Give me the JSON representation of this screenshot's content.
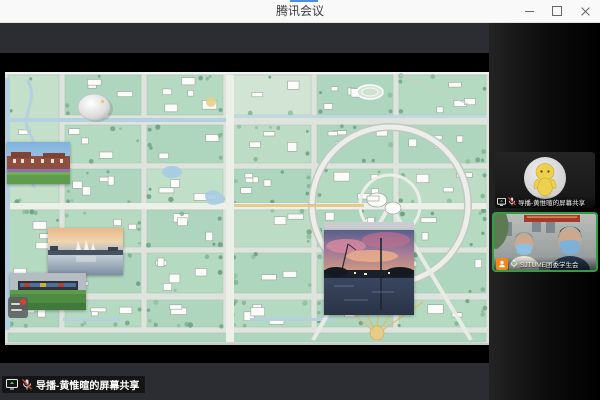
{
  "window": {
    "title": "腾讯会议",
    "controls": [
      {
        "icon": "minimize-icon"
      },
      {
        "icon": "maximize-icon"
      },
      {
        "icon": "close-icon"
      }
    ]
  },
  "stage": {
    "share_label": "导播-黄惟暄的屏幕共享",
    "share_label_icons": [
      "screen-share-icon",
      "mic-muted-icon"
    ]
  },
  "sidebar": {
    "participants": [
      {
        "name": "导播-黄惟暄的屏幕共享",
        "mic": "muted",
        "sharing": true,
        "avatar": "yellow-figure-avatar"
      },
      {
        "name": "SJTUME团委学生会",
        "mic": "on",
        "speaking": true,
        "badge": "orange-person-badge"
      }
    ]
  },
  "colors": {
    "speaking_border": "#2f9e44",
    "badge_orange": "#f0861e",
    "mic_muted_red": "#e03c30",
    "titlebar_accent": "#4a90e2",
    "share_band": "#2b2d32",
    "map_green": "#aed6bf",
    "map_water": "#b4d0e1"
  }
}
